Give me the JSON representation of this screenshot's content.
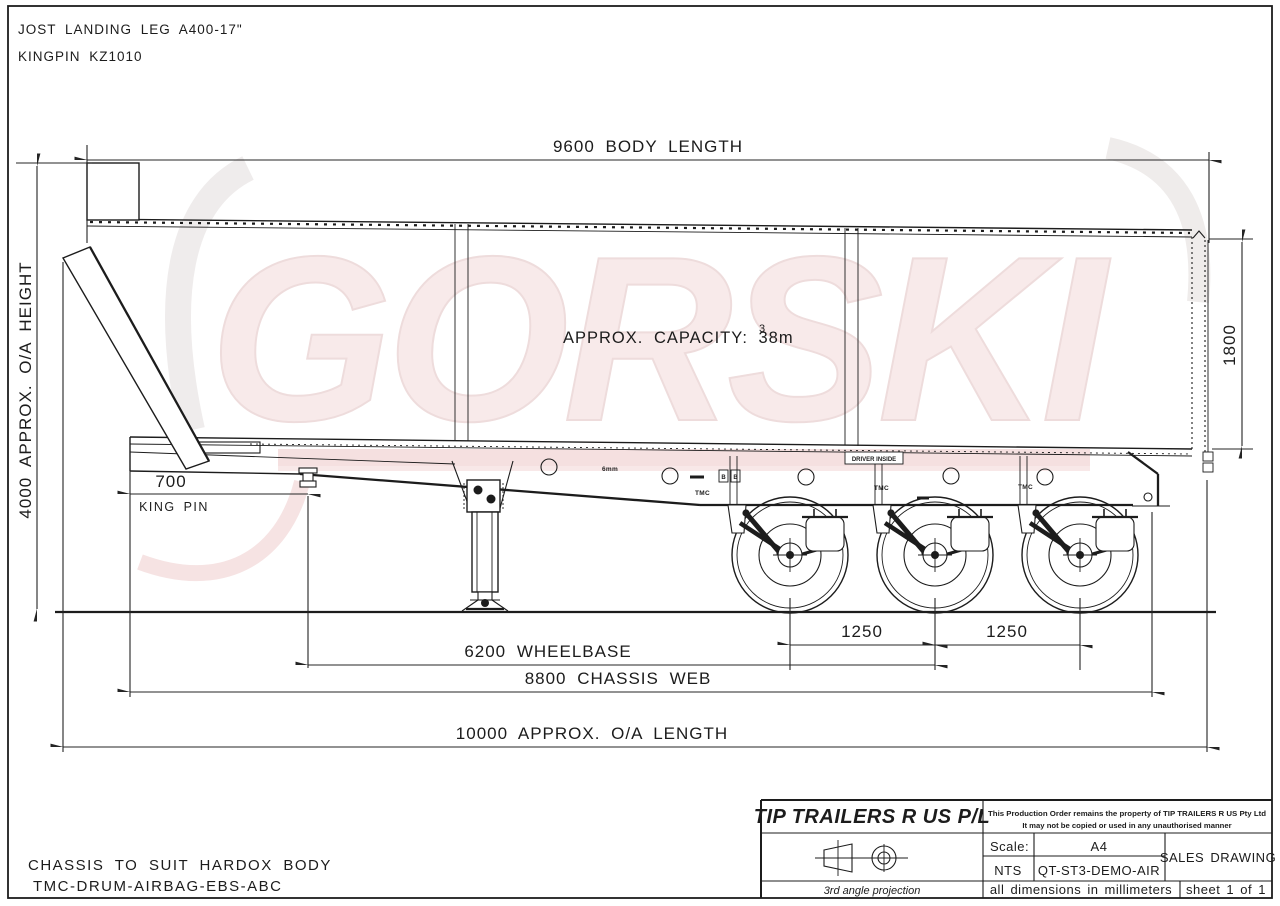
{
  "colors": {
    "background": "#ffffff",
    "line": "#1c1c1c",
    "watermark": "#f8eaea",
    "watermark_band": "#f0d6d6"
  },
  "header_notes": {
    "line1": "JOST LANDING LEG A400-17\"",
    "line2": "KINGPIN KZ1010"
  },
  "body_annotations": {
    "watermark": "GORSKI",
    "capacity": "APPROX. CAPACITY: 38m",
    "capacity_exponent": "3",
    "driver_inside": "DRIVER INSIDE",
    "floor_plate": "6mm",
    "axle_label_1": "TMC",
    "axle_label_2": "TMC",
    "axle_label_3": "TMC",
    "marker_b_left": "B",
    "marker_b_right": "B"
  },
  "dimensions": {
    "body_length": "9600 BODY LENGTH",
    "overall_height": "4000 APPROX. O/A HEIGHT",
    "body_height": "1800",
    "kingpin_setback": "700",
    "kingpin_label": "KING PIN",
    "axle_spacing_front": "1250",
    "axle_spacing_rear": "1250",
    "wheelbase": "6200 WHEELBASE",
    "chassis_web": "8800 CHASSIS WEB",
    "overall_length": "10000 APPROX. O/A LENGTH"
  },
  "footer_notes": {
    "line1": "CHASSIS TO SUIT HARDOX BODY",
    "line2": "TMC-DRUM-AIRBAG-EBS-ABC"
  },
  "title_block": {
    "company": "TIP TRAILERS R US P/L",
    "property_notice_line1": "This Production Order remains the property of TIP TRAILERS R US Pty Ltd",
    "property_notice_line2": "It may not be copied or used in any unauthorised manner",
    "scale_label": "Scale:",
    "paper_size": "A4",
    "scale_value": "NTS",
    "drawing_code": "QT-ST3-DEMO-AIR",
    "drawing_type": "SALES DRAWING",
    "projection": "3rd angle projection",
    "units_note": "all dimensions in millimeters",
    "sheet": "sheet 1 of 1"
  }
}
